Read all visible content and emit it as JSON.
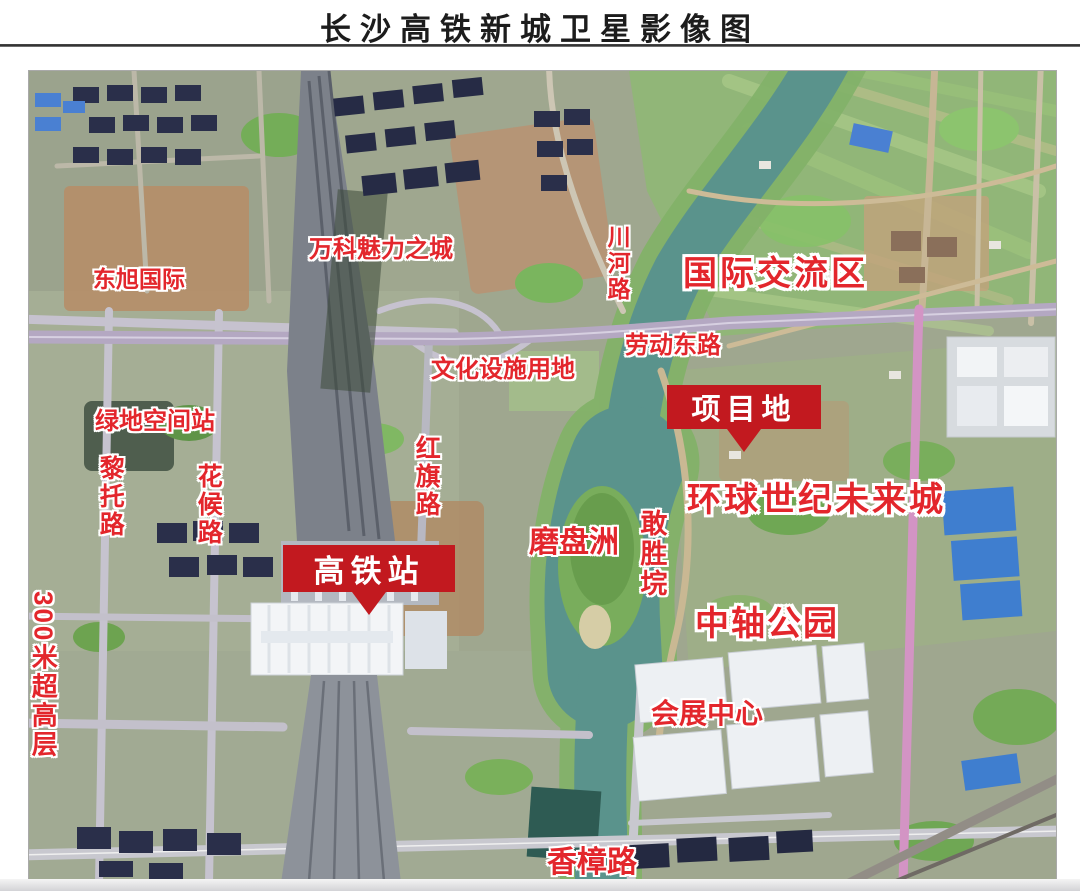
{
  "page": {
    "title": "长沙高铁新城卫星影像图"
  },
  "colors": {
    "label_red": "#E3262C",
    "callout_red": "#C2191F",
    "callout_text": "#FFFFFF",
    "river_teal": "#5A938C"
  },
  "map": {
    "labels": [
      {
        "id": "dongxu-international",
        "text": "东旭国际",
        "orientation": "horizontal"
      },
      {
        "id": "vanke-charm-city",
        "text": "万科魅力之城",
        "orientation": "horizontal"
      },
      {
        "id": "chuanhe-road",
        "text": "川河路",
        "orientation": "vertical"
      },
      {
        "id": "international-exchange-zone",
        "text": "国际交流区",
        "orientation": "horizontal"
      },
      {
        "id": "laodong-east-road",
        "text": "劳动东路",
        "orientation": "horizontal"
      },
      {
        "id": "cultural-facilities-land",
        "text": "文化设施用地",
        "orientation": "horizontal"
      },
      {
        "id": "greenland-space-station",
        "text": "绿地空间站",
        "orientation": "horizontal"
      },
      {
        "id": "lituo-road",
        "text": "黎托路",
        "orientation": "vertical"
      },
      {
        "id": "huahou-road",
        "text": "花候路",
        "orientation": "vertical"
      },
      {
        "id": "hongqi-road",
        "text": "红旗路",
        "orientation": "vertical"
      },
      {
        "id": "mopanzhou-islet",
        "text": "磨盘洲",
        "orientation": "horizontal"
      },
      {
        "id": "ganshengyuan",
        "text": "敢胜垸",
        "orientation": "vertical"
      },
      {
        "id": "global-century-future-city",
        "text": "环球世纪未来城",
        "orientation": "horizontal"
      },
      {
        "id": "central-axis-park",
        "text": "中轴公园",
        "orientation": "horizontal"
      },
      {
        "id": "convention-center",
        "text": "会展中心",
        "orientation": "horizontal"
      },
      {
        "id": "super-highrise-300m",
        "text": "300米超高层",
        "orientation": "vertical"
      },
      {
        "id": "xiangzhang-road",
        "text": "香樟路",
        "orientation": "horizontal"
      }
    ],
    "callouts": [
      {
        "id": "project-site",
        "text": "项目地"
      },
      {
        "id": "hsr-station",
        "text": "高铁站"
      }
    ]
  }
}
